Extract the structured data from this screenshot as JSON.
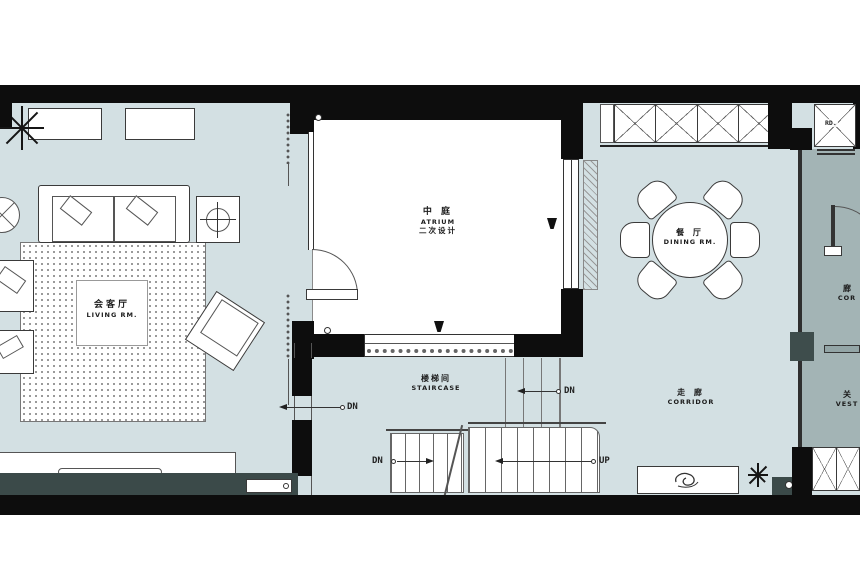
{
  "colors": {
    "floor_light": "#d3e0e3",
    "floor_dark": "#a3b4b5",
    "wall_black": "#0d0d0d",
    "panel_dark": "#3b4a49",
    "line": "#3a3a3a",
    "background": "#ffffff"
  },
  "rooms": {
    "living": {
      "zh": "会客厅",
      "en": "LIVING RM."
    },
    "atrium": {
      "zh": "中  庭",
      "en": "ATRIUM",
      "note": "二次设计"
    },
    "dining": {
      "zh": "餐  厅",
      "en": "DINING RM."
    },
    "staircase": {
      "zh": "楼梯间",
      "en": "STAIRCASE"
    },
    "corridor": {
      "zh": "走  廊",
      "en": "CORRIDOR"
    },
    "corridor_cut": {
      "zh": "廊",
      "en": "COR"
    },
    "vestibule_cut": {
      "zh": "关",
      "en": "VEST"
    }
  },
  "stairs": {
    "dn": "DN",
    "up": "UP"
  },
  "labels": {
    "rd": "RD."
  }
}
